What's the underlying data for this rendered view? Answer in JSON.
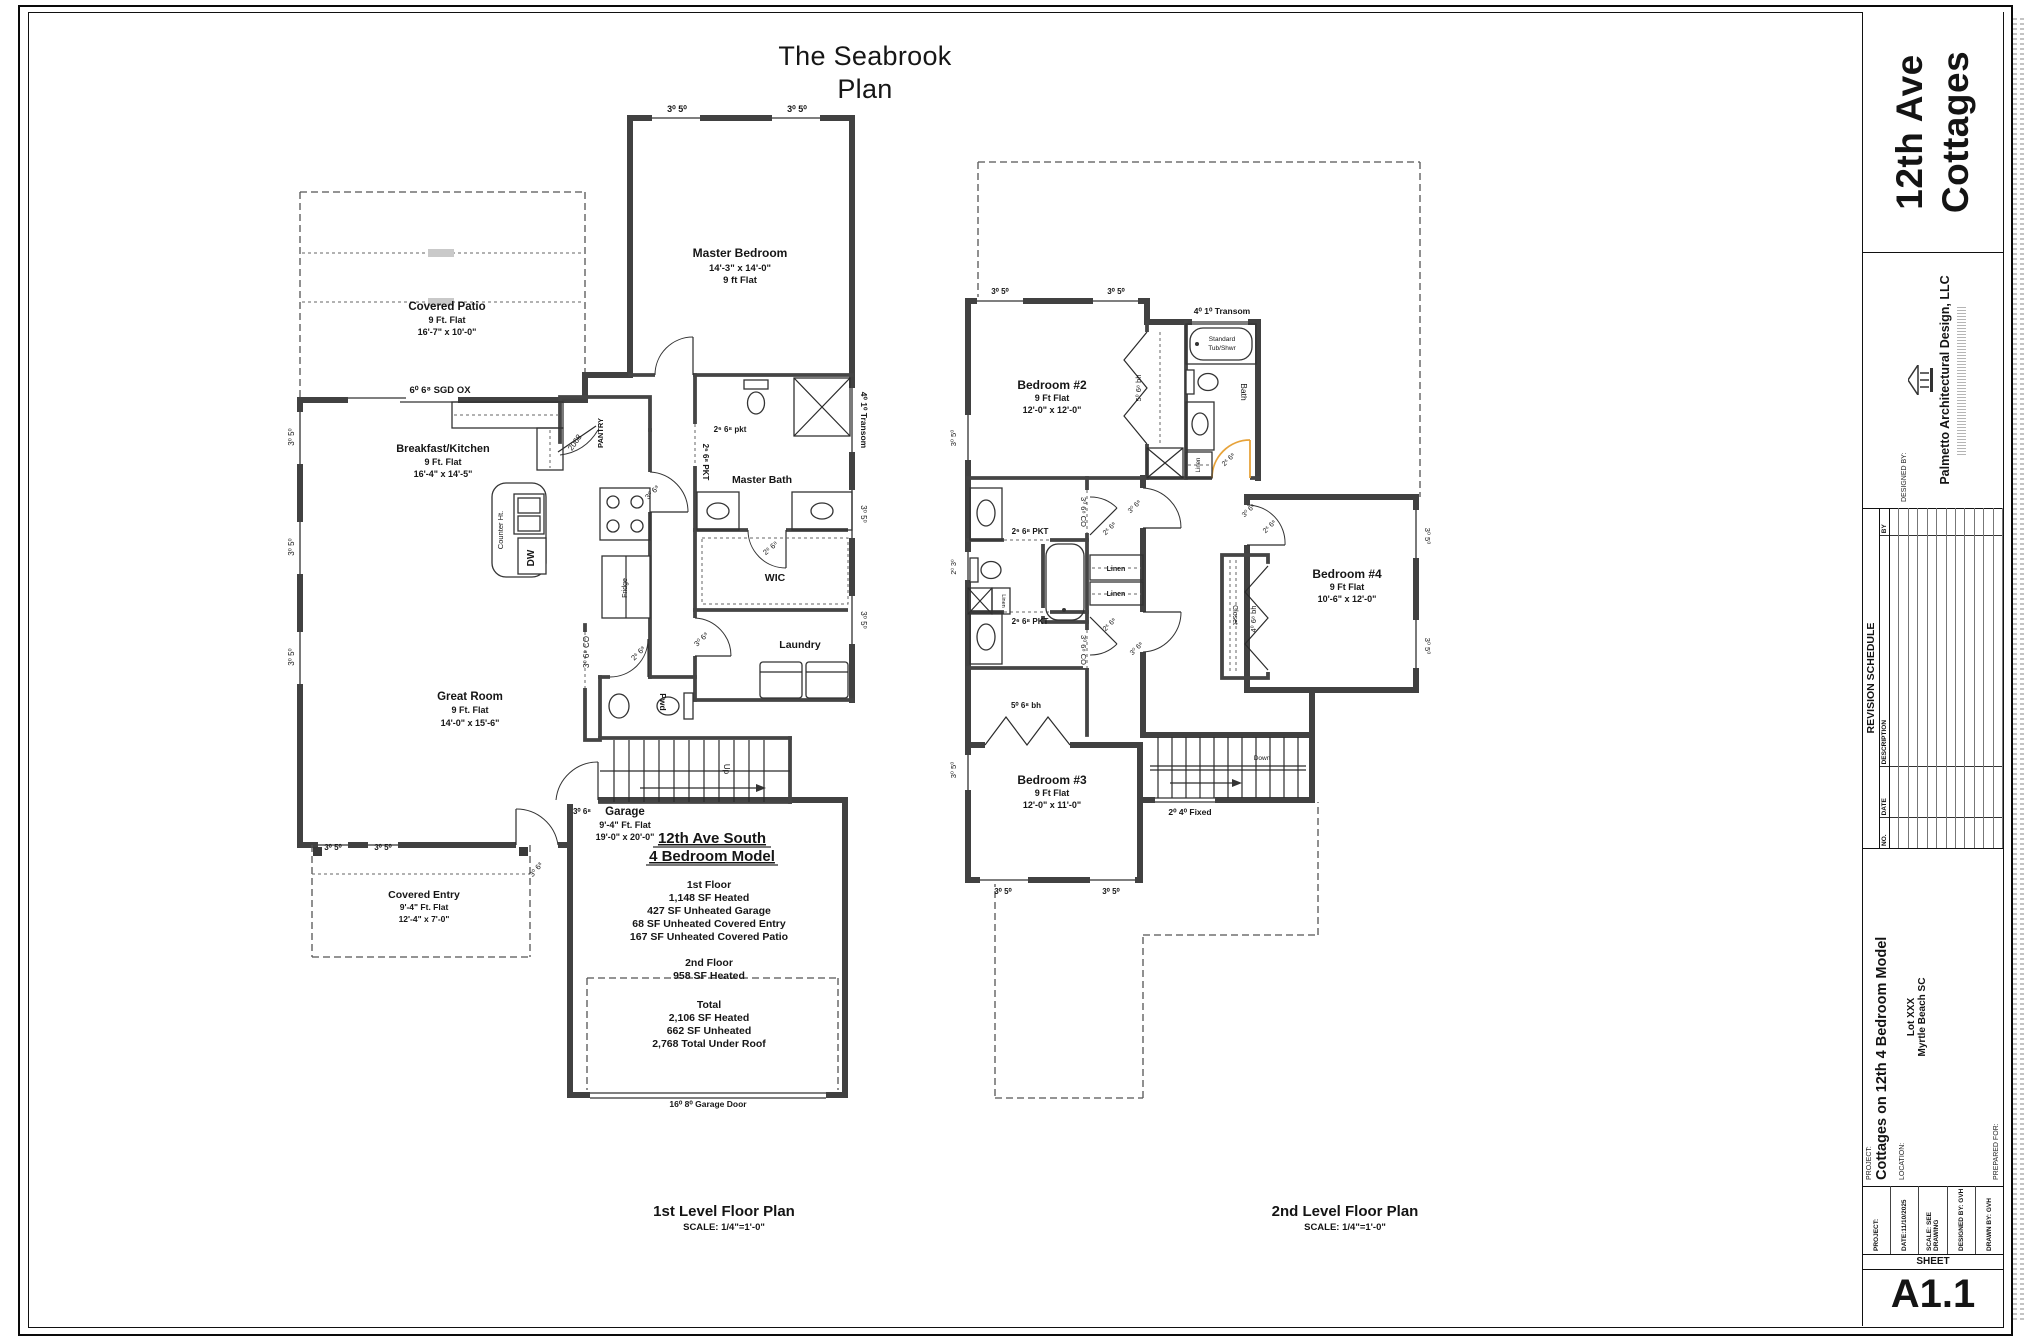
{
  "sheet": {
    "title_line1": "The Seabrook",
    "title_line2": "Plan",
    "footer": {
      "plan1_label": "1st Level Floor Plan",
      "plan1_scale": "SCALE: 1/4\"=1'-0\"",
      "plan2_label": "2nd Level Floor Plan",
      "plan2_scale": "SCALE: 1/4\"=1'-0\""
    }
  },
  "titleblock": {
    "big_line1": "12th Ave",
    "big_line2": "Cottages",
    "designed_by_label": "DESIGNED BY:",
    "firm": "Palmetto Architectural Design, LLC",
    "revision": {
      "title": "REVISION SCHEDULE",
      "columns": [
        "NO.",
        "DATE",
        "DESCRIPTION",
        "BY"
      ],
      "rows": 12
    },
    "project_label": "PROJECT:",
    "project_name": "Cottages on 12th 4 Bedroom Model",
    "location_label": "LOCATION:",
    "location_line1": "Lot XXX",
    "location_line2": "Myrtle Beach SC",
    "prepared_for_label": "PREPARED FOR:",
    "info": {
      "project": "PROJECT:",
      "date": "DATE:11/10/2025",
      "scale": "SCALE: SEE DRAWING",
      "designed_by": "DESIGNED BY: GVH",
      "drawn_by": "DRAWN BY: GVH"
    },
    "sheet_label": "SHEET",
    "sheet_number": "A1.1"
  },
  "plan1": {
    "labels": [
      {
        "name": "win-mbr-1",
        "text": "3⁰ 5⁰",
        "x": 677,
        "y": 112,
        "fs": 9,
        "b": 1
      },
      {
        "name": "win-mbr-2",
        "text": "3⁰ 5⁰",
        "x": 797,
        "y": 112,
        "fs": 9,
        "b": 1
      },
      {
        "name": "room-master-bedroom",
        "text": "Master Bedroom",
        "x": 740,
        "y": 257,
        "fs": 12,
        "b": 1
      },
      {
        "name": "dim-master-bedroom",
        "text": "14'-3\" x 14'-0\"",
        "x": 740,
        "y": 271,
        "fs": 9.5,
        "b": 1
      },
      {
        "name": "ht-master-bedroom",
        "text": "9 ft Flat",
        "x": 740,
        "y": 283,
        "fs": 9.5,
        "b": 1
      },
      {
        "name": "transom-label",
        "text": "4⁰ 1⁰ Transom",
        "x": 861,
        "y": 420,
        "fs": 8.5,
        "b": 1,
        "rot": 90
      },
      {
        "name": "room-covered-patio",
        "text": "Covered Patio",
        "x": 447,
        "y": 310,
        "fs": 11.5,
        "b": 1
      },
      {
        "name": "ht-covered-patio",
        "text": "9 Ft. Flat",
        "x": 447,
        "y": 323,
        "fs": 9,
        "b": 1
      },
      {
        "name": "dim-covered-patio",
        "text": "16'-7\" x 10'-0\"",
        "x": 447,
        "y": 335,
        "fs": 9,
        "b": 1
      },
      {
        "name": "sgd-label",
        "text": "6⁰ 6⁸  SGD OX",
        "x": 440,
        "y": 393,
        "fs": 9.5,
        "b": 1
      },
      {
        "name": "room-breakfast-kitchen",
        "text": "Breakfast/Kitchen",
        "x": 443,
        "y": 452,
        "fs": 11,
        "b": 1
      },
      {
        "name": "ht-breakfast-kitchen",
        "text": "9 Ft. Flat",
        "x": 443,
        "y": 465,
        "fs": 9,
        "b": 1
      },
      {
        "name": "dim-breakfast-kitchen",
        "text": "16'-4\" x 14'-5\"",
        "x": 443,
        "y": 477,
        "fs": 9,
        "b": 1
      },
      {
        "name": "pantry-label",
        "text": "PANTRY",
        "x": 603,
        "y": 433,
        "fs": 7.5,
        "b": 1,
        "rot": -90
      },
      {
        "name": "pantry-door",
        "text": "2068",
        "x": 577,
        "y": 444,
        "fs": 8,
        "rot": -55
      },
      {
        "name": "counter-ht",
        "text": "Counter Ht.",
        "x": 503,
        "y": 530,
        "fs": 7.5,
        "rot": -90
      },
      {
        "name": "dw-label",
        "text": "DW",
        "x": 534,
        "y": 558,
        "fs": 10,
        "b": 1,
        "rot": -90
      },
      {
        "name": "fridge-label",
        "text": "Fridge",
        "x": 627,
        "y": 588,
        "fs": 7,
        "rot": -90
      },
      {
        "name": "room-great",
        "text": "Great Room",
        "x": 470,
        "y": 700,
        "fs": 11.5,
        "b": 1
      },
      {
        "name": "ht-great",
        "text": "9 Ft. Flat",
        "x": 470,
        "y": 713,
        "fs": 9,
        "b": 1
      },
      {
        "name": "dim-great",
        "text": "14'-0\" x 15'-6\"",
        "x": 470,
        "y": 726,
        "fs": 9,
        "b": 1
      },
      {
        "name": "room-master-bath",
        "text": "Master Bath",
        "x": 762,
        "y": 483,
        "fs": 10.5,
        "b": 1
      },
      {
        "name": "mb-pkt1",
        "text": "2⁶ 6⁸ pkt",
        "x": 730,
        "y": 432,
        "fs": 8,
        "b": 1
      },
      {
        "name": "mb-pkt2",
        "text": "2⁶ 6⁸ PKT",
        "x": 703,
        "y": 462,
        "fs": 8,
        "b": 1,
        "rot": 90
      },
      {
        "name": "room-wic",
        "text": "WIC",
        "x": 775,
        "y": 581,
        "fs": 10.5,
        "b": 1
      },
      {
        "name": "wic-door",
        "text": "2⁶ 6⁸",
        "x": 772,
        "y": 550,
        "fs": 7.5,
        "rot": -40
      },
      {
        "name": "room-laundry",
        "text": "Laundry",
        "x": 800,
        "y": 648,
        "fs": 10.5,
        "b": 1
      },
      {
        "name": "hall-door1",
        "text": "3⁰ 6⁸",
        "x": 654,
        "y": 494,
        "fs": 7.5,
        "rot": -45
      },
      {
        "name": "co-kitchen",
        "text": "3⁰ 6⁸ CO",
        "x": 589,
        "y": 652,
        "fs": 8,
        "rot": -90
      },
      {
        "name": "pwd-label",
        "text": "Pwd",
        "x": 660,
        "y": 702,
        "fs": 8.5,
        "b": 1,
        "rot": 90
      },
      {
        "name": "pwd-door",
        "text": "2⁶ 6⁸",
        "x": 640,
        "y": 655,
        "fs": 7.5,
        "rot": -45
      },
      {
        "name": "hall-door2",
        "text": "3⁰ 6⁸",
        "x": 703,
        "y": 641,
        "fs": 7.5,
        "rot": -45
      },
      {
        "name": "stairs-up",
        "text": "Up",
        "x": 724,
        "y": 769,
        "fs": 8,
        "rot": 90
      },
      {
        "name": "room-garage",
        "text": "Garage",
        "x": 625,
        "y": 815,
        "fs": 11.5,
        "b": 1
      },
      {
        "name": "ht-garage",
        "text": "9'-4\" Ft. Flat",
        "x": 625,
        "y": 828,
        "fs": 9,
        "b": 1
      },
      {
        "name": "dim-garage",
        "text": "19'-0\" x 20'-0\"",
        "x": 625,
        "y": 840,
        "fs": 9,
        "b": 1
      },
      {
        "name": "model-line1",
        "text": "12th Ave South",
        "x": 712,
        "y": 843,
        "fs": 15,
        "b": 1,
        "u": 1
      },
      {
        "name": "model-line2",
        "text": "4 Bedroom Model",
        "x": 712,
        "y": 861,
        "fs": 15,
        "b": 1,
        "u": 1
      },
      {
        "name": "sf-1st-floor",
        "text": "1st Floor",
        "x": 709,
        "y": 888,
        "fs": 10.5,
        "b": 1
      },
      {
        "name": "sf-heated-1",
        "text": "1,148 SF Heated",
        "x": 709,
        "y": 901,
        "fs": 10.5,
        "b": 1
      },
      {
        "name": "sf-garage",
        "text": "427 SF Unheated Garage",
        "x": 709,
        "y": 914,
        "fs": 10.5,
        "b": 1
      },
      {
        "name": "sf-entry",
        "text": "68 SF Unheated Covered Entry",
        "x": 709,
        "y": 927,
        "fs": 10.5,
        "b": 1
      },
      {
        "name": "sf-patio",
        "text": "167 SF Unheated Covered Patio",
        "x": 709,
        "y": 940,
        "fs": 10.5,
        "b": 1
      },
      {
        "name": "sf-2nd-floor",
        "text": "2nd Floor",
        "x": 709,
        "y": 966,
        "fs": 10.5,
        "b": 1
      },
      {
        "name": "sf-heated-2",
        "text": "958 SF Heated",
        "x": 709,
        "y": 979,
        "fs": 10.5,
        "b": 1
      },
      {
        "name": "sf-total",
        "text": "Total",
        "x": 709,
        "y": 1008,
        "fs": 10.5,
        "b": 1
      },
      {
        "name": "sf-total-heated",
        "text": "2,106 SF Heated",
        "x": 709,
        "y": 1021,
        "fs": 10.5,
        "b": 1
      },
      {
        "name": "sf-total-unheated",
        "text": "662 SF Unheated",
        "x": 709,
        "y": 1034,
        "fs": 10.5,
        "b": 1
      },
      {
        "name": "sf-under-roof",
        "text": "2,768 Total Under Roof",
        "x": 709,
        "y": 1047,
        "fs": 10.5,
        "b": 1
      },
      {
        "name": "garage-door-label",
        "text": "16⁰ 8⁰ Garage Door",
        "x": 708,
        "y": 1107,
        "fs": 8.5,
        "b": 1
      },
      {
        "name": "room-covered-entry",
        "text": "Covered Entry",
        "x": 424,
        "y": 898,
        "fs": 10.5,
        "b": 1
      },
      {
        "name": "ht-covered-entry",
        "text": "9'-4\" Ft. Flat",
        "x": 424,
        "y": 910,
        "fs": 8.5,
        "b": 1
      },
      {
        "name": "dim-covered-entry",
        "text": "12'-4\" x 7'-0\"",
        "x": 424,
        "y": 922,
        "fs": 8.5,
        "b": 1
      },
      {
        "name": "front-door",
        "text": "3⁰ 6⁸",
        "x": 538,
        "y": 871,
        "fs": 7.5,
        "rot": -50
      },
      {
        "name": "garage-entry-door",
        "text": "3⁰ 6⁸",
        "x": 582,
        "y": 814,
        "fs": 8,
        "b": 1
      },
      {
        "name": "win-front-1",
        "text": "3⁰ 5⁰",
        "x": 333,
        "y": 850,
        "fs": 8,
        "b": 1
      },
      {
        "name": "win-front-2",
        "text": "3⁰ 5⁰",
        "x": 383,
        "y": 850,
        "fs": 8,
        "b": 1
      },
      {
        "name": "win-left-1",
        "text": "3⁰ 5⁰",
        "x": 294,
        "y": 437,
        "fs": 8,
        "rot": -90
      },
      {
        "name": "win-left-2",
        "text": "3⁰ 5⁰",
        "x": 294,
        "y": 547,
        "fs": 8,
        "rot": -90
      },
      {
        "name": "win-left-3",
        "text": "3⁰ 5⁰",
        "x": 294,
        "y": 657,
        "fs": 8,
        "rot": -90
      },
      {
        "name": "win-right-1",
        "text": "3⁰ 5⁰",
        "x": 861,
        "y": 514,
        "fs": 8,
        "rot": 90
      },
      {
        "name": "win-right-2",
        "text": "3⁰ 5⁰",
        "x": 861,
        "y": 620,
        "fs": 8,
        "rot": 90
      }
    ]
  },
  "plan2": {
    "labels": [
      {
        "name": "win-b2-1",
        "text": "3⁰ 5⁰",
        "x": 1000,
        "y": 294,
        "fs": 8,
        "b": 1
      },
      {
        "name": "win-b2-2",
        "text": "3⁰ 5⁰",
        "x": 1116,
        "y": 294,
        "fs": 8,
        "b": 1
      },
      {
        "name": "room-bedroom2",
        "text": "Bedroom #2",
        "x": 1052,
        "y": 389,
        "fs": 12,
        "b": 1
      },
      {
        "name": "ht-bedroom2",
        "text": "9 Ft Flat",
        "x": 1052,
        "y": 401,
        "fs": 9,
        "b": 1
      },
      {
        "name": "dim-bedroom2",
        "text": "12'-0\" x 12'-0\"",
        "x": 1052,
        "y": 413,
        "fs": 9,
        "b": 1
      },
      {
        "name": "b2-closet-door",
        "text": "5⁰ 6⁸ bh",
        "x": 1141,
        "y": 388,
        "fs": 7.5,
        "rot": -90
      },
      {
        "name": "transom2-label",
        "text": "4⁰ 1⁰ Transom",
        "x": 1222,
        "y": 314,
        "fs": 8.5,
        "b": 1
      },
      {
        "name": "tub-line1",
        "text": "Standard",
        "x": 1222,
        "y": 341,
        "fs": 6.5
      },
      {
        "name": "tub-line2",
        "text": "Tub/Shwr",
        "x": 1222,
        "y": 350,
        "fs": 6.5
      },
      {
        "name": "bath-label",
        "text": "Bath",
        "x": 1241,
        "y": 392,
        "fs": 8.5,
        "rot": 90
      },
      {
        "name": "bath-linen",
        "text": "Linen",
        "x": 1200,
        "y": 465,
        "fs": 6,
        "rot": -90
      },
      {
        "name": "bath-door",
        "text": "2⁶ 6⁸",
        "x": 1230,
        "y": 461,
        "fs": 7,
        "rot": -45
      },
      {
        "name": "pkt-a",
        "text": "2⁶ 6⁸ PKT",
        "x": 1030,
        "y": 534,
        "fs": 8,
        "b": 1
      },
      {
        "name": "pkt-b",
        "text": "2⁶ 6⁸ PKT",
        "x": 1030,
        "y": 624,
        "fs": 8,
        "b": 1
      },
      {
        "name": "co-a",
        "text": "3⁰ 6⁸ CO",
        "x": 1081,
        "y": 512,
        "fs": 7.5,
        "rot": 90
      },
      {
        "name": "co-b",
        "text": "3⁰ 6⁸ CO",
        "x": 1081,
        "y": 650,
        "fs": 7.5,
        "rot": 90
      },
      {
        "name": "linen-1",
        "text": "Linen",
        "x": 1116,
        "y": 571,
        "fs": 7,
        "b": 1
      },
      {
        "name": "linen-2",
        "text": "Linen",
        "x": 1116,
        "y": 596,
        "fs": 7,
        "b": 1
      },
      {
        "name": "linen-small",
        "text": "Linen",
        "x": 1002,
        "y": 601,
        "fs": 5.5,
        "rot": 90
      },
      {
        "name": "door-a",
        "text": "3⁰ 6⁸",
        "x": 1136,
        "y": 508,
        "fs": 7,
        "rot": -45
      },
      {
        "name": "door-b",
        "text": "2⁶ 6⁸",
        "x": 1111,
        "y": 530,
        "fs": 7,
        "rot": -45
      },
      {
        "name": "door-c",
        "text": "2⁶ 6⁸",
        "x": 1111,
        "y": 626,
        "fs": 7,
        "rot": -45
      },
      {
        "name": "door-d",
        "text": "3⁰ 6⁸",
        "x": 1138,
        "y": 650,
        "fs": 7,
        "rot": -45
      },
      {
        "name": "toilet-win",
        "text": "2⁰ 3⁰",
        "x": 956,
        "y": 567,
        "fs": 7,
        "rot": -90
      },
      {
        "name": "b3-closet-door",
        "text": "5⁰ 6⁸ bh",
        "x": 1026,
        "y": 708,
        "fs": 8,
        "b": 1
      },
      {
        "name": "room-bedroom3",
        "text": "Bedroom #3",
        "x": 1052,
        "y": 784,
        "fs": 12,
        "b": 1
      },
      {
        "name": "ht-bedroom3",
        "text": "9 Ft Flat",
        "x": 1052,
        "y": 796,
        "fs": 9,
        "b": 1
      },
      {
        "name": "dim-bedroom3",
        "text": "12'-0\" x 11'-0\"",
        "x": 1052,
        "y": 808,
        "fs": 9,
        "b": 1
      },
      {
        "name": "win-b3-1",
        "text": "3⁰ 5⁰",
        "x": 1003,
        "y": 894,
        "fs": 8,
        "b": 1
      },
      {
        "name": "win-b3-2",
        "text": "3⁰ 5⁰",
        "x": 1111,
        "y": 894,
        "fs": 8,
        "b": 1
      },
      {
        "name": "win-b3-left",
        "text": "3⁰ 5⁰",
        "x": 956,
        "y": 770,
        "fs": 7.5,
        "rot": -90
      },
      {
        "name": "win-b2-left",
        "text": "3⁰ 5⁰",
        "x": 956,
        "y": 438,
        "fs": 7.5,
        "rot": -90
      },
      {
        "name": "fixed-window",
        "text": "2⁰ 4⁰ Fixed",
        "x": 1190,
        "y": 815,
        "fs": 8.5,
        "b": 1
      },
      {
        "name": "stairs-down",
        "text": "Down",
        "x": 1262,
        "y": 760,
        "fs": 6.5
      },
      {
        "name": "room-bedroom4",
        "text": "Bedroom #4",
        "x": 1347,
        "y": 578,
        "fs": 12,
        "b": 1
      },
      {
        "name": "ht-bedroom4",
        "text": "9 Ft Flat",
        "x": 1347,
        "y": 590,
        "fs": 9,
        "b": 1
      },
      {
        "name": "dim-bedroom4",
        "text": "10'-6\" x 12'-0\"",
        "x": 1347,
        "y": 602,
        "fs": 9,
        "b": 1
      },
      {
        "name": "b4-closet",
        "text": "Closet",
        "x": 1233,
        "y": 615,
        "fs": 7,
        "rot": 90
      },
      {
        "name": "b4-closet-door",
        "text": "4⁰ 6⁸ bh",
        "x": 1256,
        "y": 619,
        "fs": 7.5,
        "rot": -90
      },
      {
        "name": "b4-door1",
        "text": "3⁰ 6⁸",
        "x": 1250,
        "y": 512,
        "fs": 7,
        "rot": -45
      },
      {
        "name": "b4-door2",
        "text": "2⁶ 6⁸",
        "x": 1271,
        "y": 528,
        "fs": 7,
        "rot": -45
      },
      {
        "name": "win-b4-1",
        "text": "3⁰ 5⁰",
        "x": 1425,
        "y": 536,
        "fs": 7.5,
        "rot": 90
      },
      {
        "name": "win-b4-2",
        "text": "3⁰ 5⁰",
        "x": 1425,
        "y": 646,
        "fs": 7.5,
        "rot": 90
      }
    ]
  }
}
